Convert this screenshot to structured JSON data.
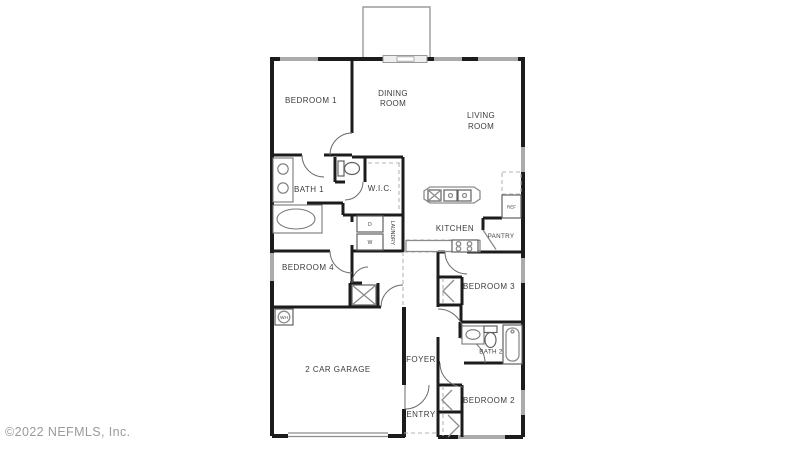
{
  "watermark": "©2022 NEFMLS, Inc.",
  "rooms": {
    "bedroom1": {
      "label": "BEDROOM 1"
    },
    "dining_room": {
      "line1": "DINING",
      "line2": "ROOM"
    },
    "living_room": {
      "line1": "LIVING",
      "line2": "ROOM"
    },
    "bath1": {
      "label": "BATH 1"
    },
    "wic": {
      "label": "W.I.C."
    },
    "kitchen": {
      "label": "KITCHEN"
    },
    "pantry": {
      "label": "PANTRY"
    },
    "laundry": {
      "label": "LAUNDRY"
    },
    "bedroom4": {
      "label": "BEDROOM 4"
    },
    "bedroom3": {
      "label": "BEDROOM 3"
    },
    "bath2": {
      "label": "BATH 2"
    },
    "bedroom2": {
      "label": "BEDROOM 2"
    },
    "garage": {
      "label": "2 CAR GARAGE"
    },
    "foyer": {
      "label": "FOYER"
    },
    "entry": {
      "label": "ENTRY"
    }
  },
  "appliances": {
    "dryer": "D",
    "washer": "W",
    "refrigerator": "REF",
    "water_heater": "WH"
  },
  "colors": {
    "wall": "#1c1c1c",
    "window": "#ababab",
    "fixture": "#787878",
    "dashed": "#b5b5b5",
    "text": "#3c3c3c",
    "watermark": "#9b9b9b",
    "background": "#ffffff"
  }
}
